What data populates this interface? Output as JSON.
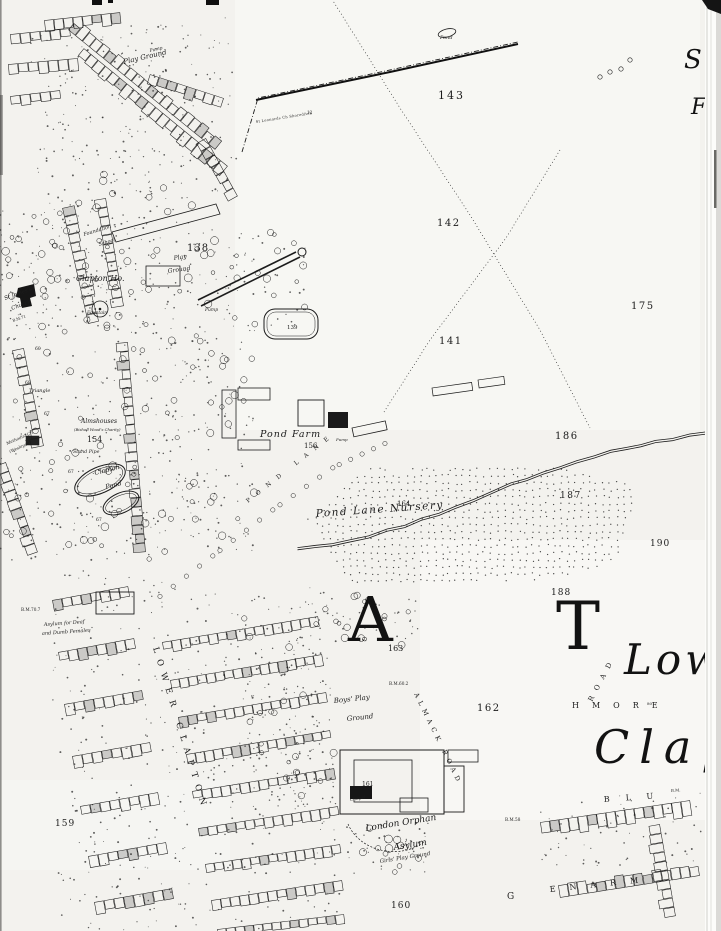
{
  "colors": {
    "ink": "#1c1c1c",
    "paper": "#f3f2ee",
    "paper_light": "#f9f9f6",
    "margin": "#fcfcfa",
    "edge_shadow": "#c9c8c4",
    "building_fill": "rgba(20,20,20,0.18)"
  },
  "labels": {
    "play_ground_nw": "Play Ground",
    "pump_nw": "Pump",
    "pond_nw": "Pond",
    "boundary_text": "St Leonards Ch Shoreditch",
    "boundary_12": "12",
    "n143": "143",
    "n142": "142",
    "n175": "175",
    "n141": "141",
    "n139": "139",
    "n138": "138",
    "school_1": "Foundation",
    "school_2": "School",
    "play_school_1": "Play",
    "play_school_2": "Ground",
    "clapton_ho": "Clapton Ho.",
    "st_james_1": "St James's",
    "st_james_2": "Church",
    "bm71": "B.M.71",
    "fountain": "Fountain",
    "pump_mid": "Pump",
    "sh60": "60",
    "sh68a": "68",
    "sh67a": "67",
    "sh67b": "67",
    "sh67c": "67",
    "triangle": "Triangle",
    "almshouses_1": "Almshouses",
    "almshouses_2": "(Bishop Wood's Charity)",
    "n154": "154",
    "stand_pipe": "Stand Pipe",
    "methodist_1": "Methodist Ch.",
    "methodist_2": "(Wesleyan)",
    "clapton_pond_1": "Clapton",
    "clapton_pond_2": "Pond",
    "pond_farm": "Pond Farm",
    "n156": "156",
    "pump_farm": "Pump",
    "n186": "186",
    "n187": "187",
    "nursery": "Pond Lane Nursery",
    "n164": "164",
    "pond_lane": "POND LANE",
    "n190": "190",
    "n188": "188",
    "n163": "163",
    "n162": "162",
    "big_a": "A",
    "big_t": "T",
    "big_low": "Low",
    "big_clap": "Clap",
    "rushmore": "HMORE",
    "sh80": "80",
    "almack_road": "ALMACK ROAD",
    "road_ne": "ROAD",
    "deaf_1": "Asylum for Deaf",
    "deaf_2": "and Dumb Females",
    "bm707": "B.M.70.7",
    "bm602": "B.M.60.2",
    "bm58": "B.M.58",
    "boys_1": "Boys' Play",
    "boys_2": "Ground",
    "lower_clapton": "LOWER CLAPTON",
    "orphan_1": "London Orphan",
    "orphan_2": "Asylum",
    "orphan_3": "Girls' Play Ground",
    "chapel": "Chapel",
    "n161": "161",
    "n160": "160",
    "n159": "159",
    "blurton": "BLU",
    "bm_blu": "B.M.",
    "glenarm": "ENARM",
    "sh68b": "68",
    "g_letter": "G",
    "s_right": "S",
    "f_right": "F"
  }
}
